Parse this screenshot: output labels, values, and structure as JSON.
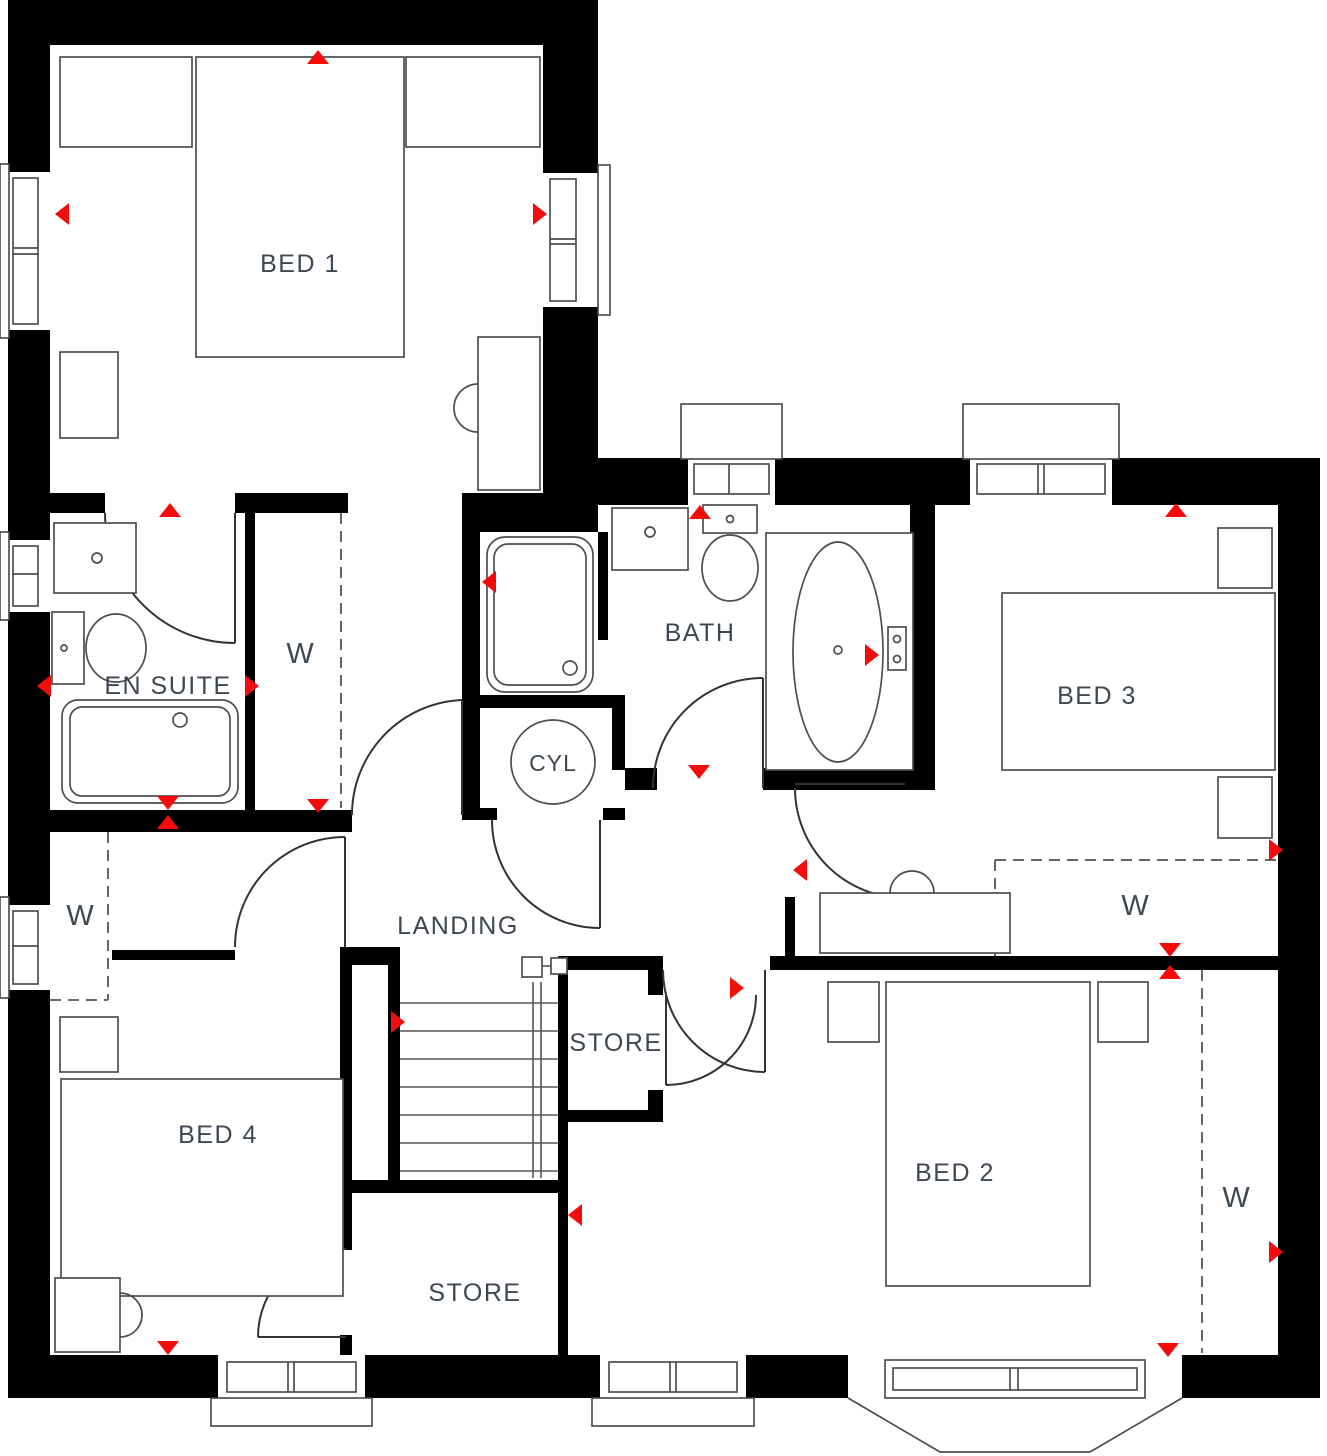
{
  "plan": {
    "colors": {
      "wall": "#000000",
      "fixture_line": "#4d4d4d",
      "label": "#3d4852",
      "marker": "#f20d0d",
      "background": "#ffffff"
    },
    "rooms": [
      {
        "id": "bed1",
        "label": "BED 1",
        "x": 300,
        "y": 272
      },
      {
        "id": "ensuite",
        "label": "EN SUITE",
        "x": 168,
        "y": 694
      },
      {
        "id": "w-ensuite",
        "label": "W",
        "x": 300,
        "y": 663
      },
      {
        "id": "bath",
        "label": "BATH",
        "x": 700,
        "y": 641
      },
      {
        "id": "cyl",
        "label": "CYL",
        "x": 553,
        "y": 771
      },
      {
        "id": "bed3",
        "label": "BED 3",
        "x": 1097,
        "y": 704
      },
      {
        "id": "w-bed3",
        "label": "W",
        "x": 1135,
        "y": 915
      },
      {
        "id": "landing",
        "label": "LANDING",
        "x": 458,
        "y": 934
      },
      {
        "id": "store-upper",
        "label": "STORE",
        "x": 616,
        "y": 1051
      },
      {
        "id": "bed2",
        "label": "BED 2",
        "x": 955,
        "y": 1181
      },
      {
        "id": "w-bed2",
        "label": "W",
        "x": 1236,
        "y": 1207
      },
      {
        "id": "bed4",
        "label": "BED 4",
        "x": 218,
        "y": 1143
      },
      {
        "id": "store-lower",
        "label": "STORE",
        "x": 475,
        "y": 1301
      },
      {
        "id": "w-landing",
        "label": "W",
        "x": 80,
        "y": 925
      }
    ],
    "markers": [
      {
        "x": 318,
        "y": 57,
        "dir": "up"
      },
      {
        "x": 62,
        "y": 214,
        "dir": "left"
      },
      {
        "x": 540,
        "y": 214,
        "dir": "right"
      },
      {
        "x": 170,
        "y": 510,
        "dir": "up"
      },
      {
        "x": 44,
        "y": 686,
        "dir": "left"
      },
      {
        "x": 252,
        "y": 686,
        "dir": "right"
      },
      {
        "x": 168,
        "y": 803,
        "dir": "down"
      },
      {
        "x": 168,
        "y": 822,
        "dir": "up"
      },
      {
        "x": 318,
        "y": 806,
        "dir": "down"
      },
      {
        "x": 700,
        "y": 512,
        "dir": "up"
      },
      {
        "x": 489,
        "y": 582,
        "dir": "left"
      },
      {
        "x": 872,
        "y": 655,
        "dir": "right"
      },
      {
        "x": 699,
        "y": 772,
        "dir": "down"
      },
      {
        "x": 1176,
        "y": 510,
        "dir": "up"
      },
      {
        "x": 1276,
        "y": 850,
        "dir": "right"
      },
      {
        "x": 800,
        "y": 870,
        "dir": "left"
      },
      {
        "x": 1170,
        "y": 950,
        "dir": "down"
      },
      {
        "x": 1170,
        "y": 972,
        "dir": "up"
      },
      {
        "x": 737,
        "y": 988,
        "dir": "right"
      },
      {
        "x": 398,
        "y": 1022,
        "dir": "right"
      },
      {
        "x": 575,
        "y": 1215,
        "dir": "left"
      },
      {
        "x": 168,
        "y": 1348,
        "dir": "down"
      },
      {
        "x": 1168,
        "y": 1350,
        "dir": "down"
      },
      {
        "x": 1276,
        "y": 1252,
        "dir": "right"
      }
    ]
  }
}
